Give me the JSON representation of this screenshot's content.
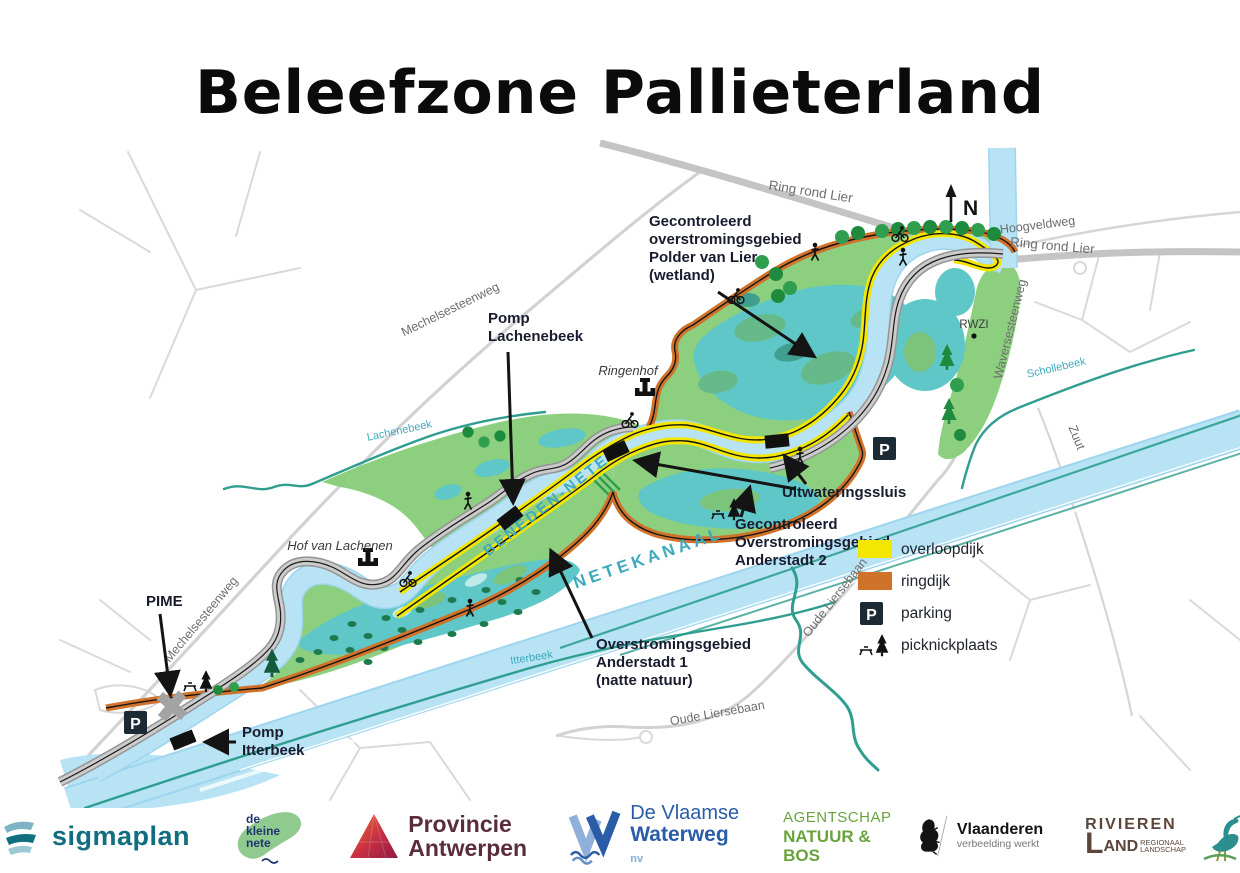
{
  "title": "Beleefzone Pallieterland",
  "map": {
    "north": "N",
    "parking_letter": "P",
    "roads": [
      "Ring rond Lier",
      "Hoogveldweg",
      "Ring rond Lier",
      "Waversesteenweg",
      "Mechelsesteenweg",
      "Mechelsesteenweg",
      "Oude Liersebaan",
      "Oude Liersebaan",
      "Zuut"
    ],
    "waters": [
      "Lachenebeek",
      "BENEDEN-NETE",
      "NETEKANAAL",
      "Schollebeek",
      "Itterbeek"
    ],
    "places": [
      "Ringenhof",
      "Hof van Lachenen",
      "RWZI"
    ],
    "callouts": {
      "polder": [
        "Gecontroleerd",
        "overstromingsgebied",
        "Polder van Lier",
        "(wetland)"
      ],
      "pomp_lachenebeek": [
        "Pomp",
        "Lachenebeek"
      ],
      "uitwateringssluis": [
        "Uitwateringssluis"
      ],
      "anderstadt2": [
        "Gecontroleerd",
        "Overstromingsgebied",
        "Anderstadt 2"
      ],
      "anderstadt1": [
        "Overstromingsgebied",
        "Anderstadt 1",
        "(natte natuur)"
      ],
      "pime": [
        "PIME"
      ],
      "pomp_itterbeek": [
        "Pomp",
        "Itterbeek"
      ]
    }
  },
  "legend": {
    "items": [
      {
        "label": "overloopdijk",
        "color": "#f3e600"
      },
      {
        "label": "ringdijk",
        "color": "#d0722a"
      },
      {
        "label": "parking"
      },
      {
        "label": "picknickplaats"
      }
    ]
  },
  "footer": {
    "logos": [
      {
        "name": "sigmaplan",
        "text": "sigmaplan"
      },
      {
        "name": "de-kleine-nete",
        "lines": [
          "de",
          "kleine",
          "nete"
        ]
      },
      {
        "name": "provincie-antwerpen",
        "line1": "Provincie",
        "line2": "Antwerpen"
      },
      {
        "name": "de-vlaamse-waterweg",
        "line1": "De Vlaamse",
        "line2": "Waterweg",
        "suffix": "nv"
      },
      {
        "name": "agentschap-natuur-en-bos",
        "line1": "AGENTSCHAP",
        "line2": "NATUUR & BOS"
      },
      {
        "name": "vlaanderen",
        "line1": "Vlaanderen",
        "line2": "verbeelding werkt"
      },
      {
        "name": "rivierenland",
        "word1": "RIVIEREN",
        "big_letter": "L",
        "word2": "AND",
        "small1": "REGIONAAL",
        "small2": "LANDSCHAP"
      }
    ]
  },
  "colors": {
    "water": "#b7e3f5",
    "wetland": "#5fc7c7",
    "floodplain_green": "#8ccf7e",
    "overloopdijk_yellow": "#f3e600",
    "ringdijk_orange": "#d0722a",
    "road_gray": "#cccccc",
    "stream_teal": "#2f9e8f",
    "water_label_teal": "#3fa9bd",
    "label_dark": "#181c2e"
  }
}
